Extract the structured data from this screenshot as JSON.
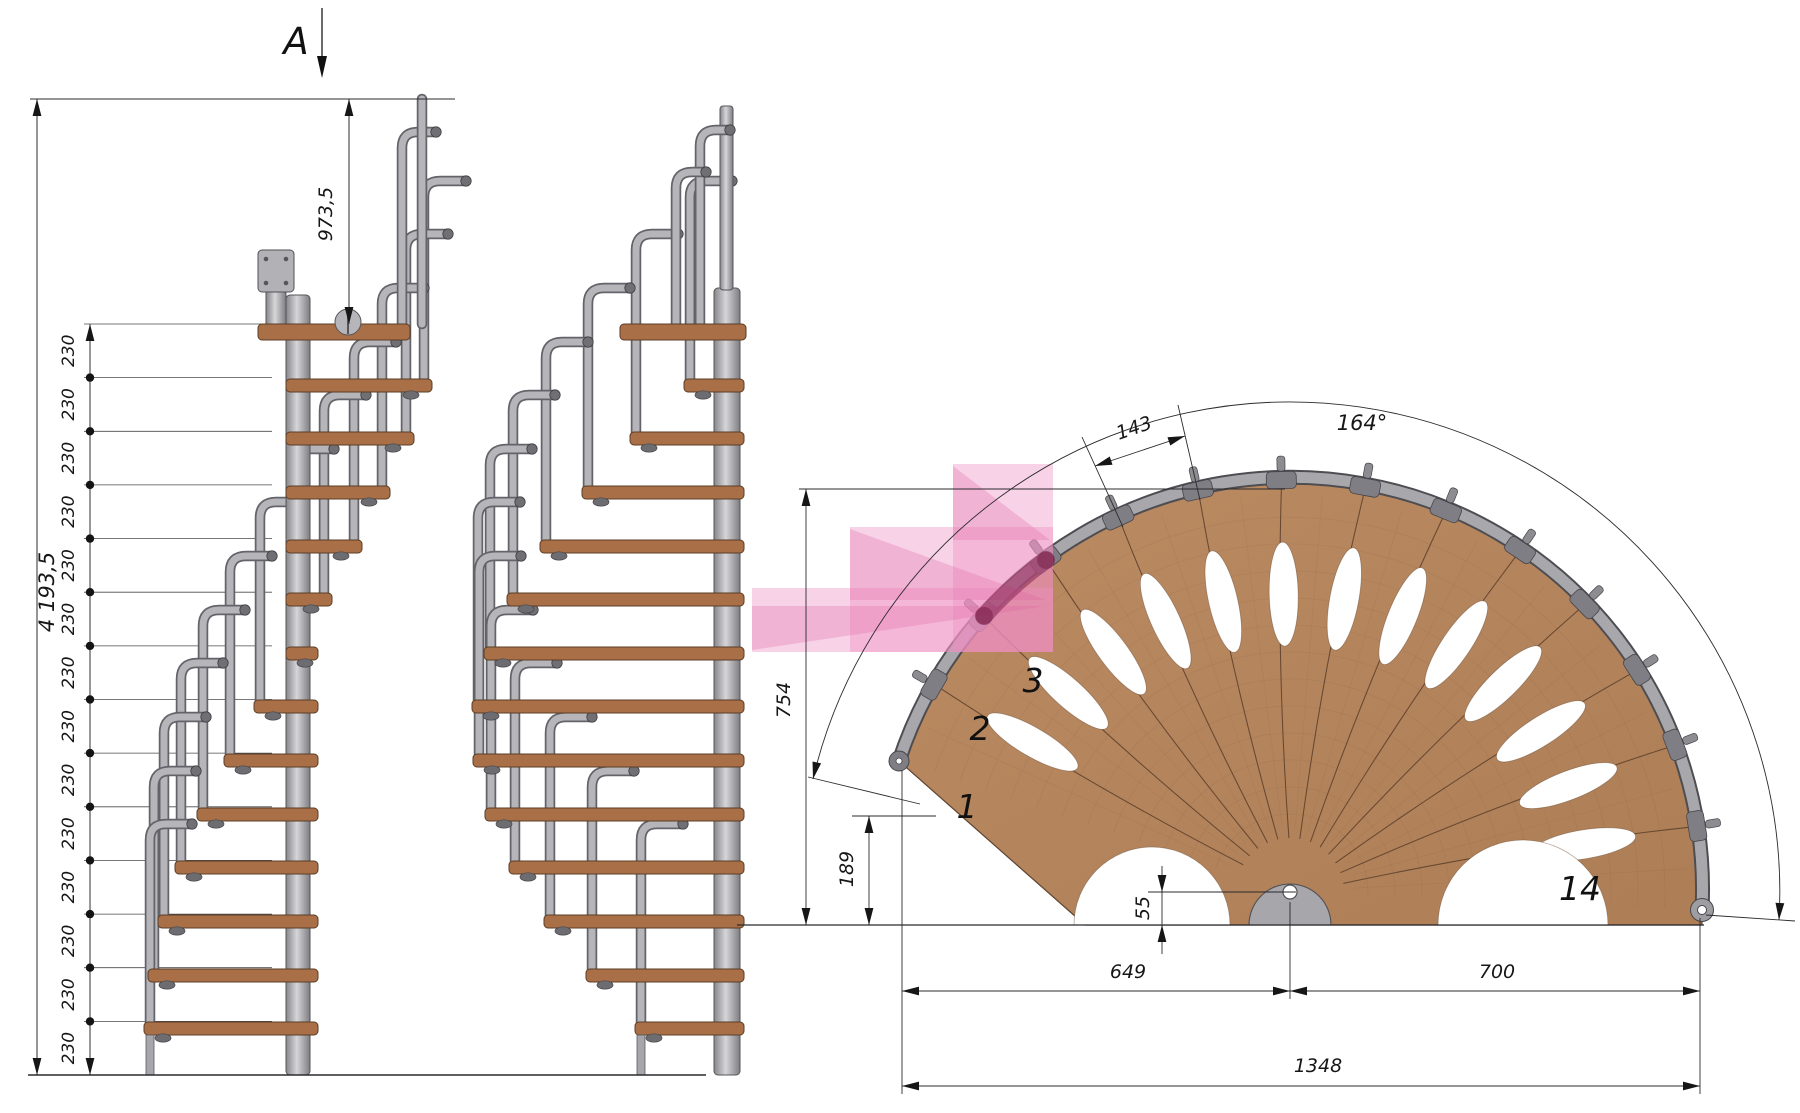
{
  "drawing": {
    "section_marker": "A",
    "elevation": {
      "total_height": "4 193,5",
      "platform_height": "973,5",
      "riser": "230",
      "riser_count": 14
    },
    "plan": {
      "sweep_angle": "164°",
      "tread_arc_width": "143",
      "radius_height": "754",
      "entry_offset": "189",
      "hub_offset": "55",
      "span_left": "649",
      "span_right": "700",
      "span_total": "1348",
      "step_first": "1",
      "step_second": "2",
      "step_third": "3",
      "step_last": "14",
      "tread_count": 14
    },
    "colors": {
      "wood": "#b4845c",
      "wood_line": "#6a4c34",
      "steel_light": "#b6b6ba",
      "steel_dark": "#5a5a5e",
      "tread_side": "#a97047",
      "highlight_pink": "#ee8fc0",
      "highlight_maroon": "#7b2248",
      "line": "#2b2b2b"
    }
  }
}
